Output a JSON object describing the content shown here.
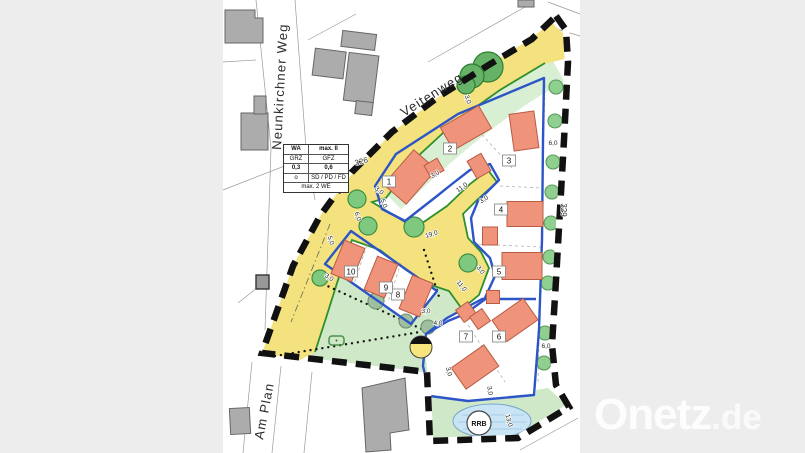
{
  "streets": [
    {
      "name": "Neunkirchner Weg"
    },
    {
      "name": "Veitenweg"
    },
    {
      "name": "Am Plan"
    }
  ],
  "parcel_numbers": [
    "326",
    "329"
  ],
  "legend": {
    "r1c1": "WA",
    "r1c2": "max. II",
    "r2c1": "GRZ",
    "r2c2": "GFZ",
    "r3c1": "0,3",
    "r3c2": "0,6",
    "r4c1": "o",
    "r4c2": "SD / PD / FD",
    "r5": "max. 2 WE"
  },
  "lots": [
    {
      "n": "1",
      "x": 389,
      "y": 184
    },
    {
      "n": "2",
      "x": 450,
      "y": 151
    },
    {
      "n": "3",
      "x": 509,
      "y": 163
    },
    {
      "n": "4",
      "x": 501,
      "y": 212
    },
    {
      "n": "5",
      "x": 499,
      "y": 274
    },
    {
      "n": "6",
      "x": 499,
      "y": 339
    },
    {
      "n": "7",
      "x": 466,
      "y": 339
    },
    {
      "n": "8",
      "x": 398,
      "y": 297
    },
    {
      "n": "9",
      "x": 386,
      "y": 290
    },
    {
      "n": "10",
      "x": 351,
      "y": 274
    }
  ],
  "dims": [
    {
      "t": "3,0",
      "x": 466,
      "y": 100,
      "r": 70
    },
    {
      "t": "6,0",
      "x": 553,
      "y": 145,
      "r": 0
    },
    {
      "t": "3,0",
      "x": 378,
      "y": 192,
      "r": 40
    },
    {
      "t": "5,0",
      "x": 382,
      "y": 204,
      "r": 70
    },
    {
      "t": "6,0",
      "x": 356,
      "y": 217,
      "r": 70
    },
    {
      "t": "5,0",
      "x": 329,
      "y": 241,
      "r": 70
    },
    {
      "t": "3,0",
      "x": 328,
      "y": 279,
      "r": 35
    },
    {
      "t": "19,0",
      "x": 432,
      "y": 236,
      "r": -18
    },
    {
      "t": "11,0",
      "x": 463,
      "y": 189,
      "r": -35
    },
    {
      "t": "3,0",
      "x": 485,
      "y": 201,
      "r": -35
    },
    {
      "t": "3,0",
      "x": 436,
      "y": 176,
      "r": -30
    },
    {
      "t": "11,0",
      "x": 460,
      "y": 287,
      "r": 52
    },
    {
      "t": "3,0",
      "x": 479,
      "y": 271,
      "r": 52
    },
    {
      "t": "3,0",
      "x": 426,
      "y": 313,
      "r": 0
    },
    {
      "t": "4,0",
      "x": 438,
      "y": 325,
      "r": 0
    },
    {
      "t": "3,0",
      "x": 447,
      "y": 372,
      "r": 75
    },
    {
      "t": "3,0",
      "x": 488,
      "y": 391,
      "r": 80
    },
    {
      "t": "13,0",
      "x": 507,
      "y": 421,
      "r": 75
    },
    {
      "t": "6,0",
      "x": 546,
      "y": 348,
      "r": 0
    }
  ],
  "rrb_label": "RRB",
  "watermark": {
    "brand": "Onetz",
    "tld": ".de"
  },
  "colors": {
    "road_yellow": "#f3e27d",
    "meadow_green": "#cfe9c8",
    "strip_green": "#d9efd3",
    "building_orange": "#f0937b",
    "building_stroke": "#b85c44",
    "envelope_blue": "#2d55c8",
    "road_edge_green": "#2f8f2f",
    "existing_gray": "#acacac",
    "pond_blue": "#c9e4f5",
    "boundary_black": "#111111",
    "letterbox_gray": "#ededed"
  }
}
